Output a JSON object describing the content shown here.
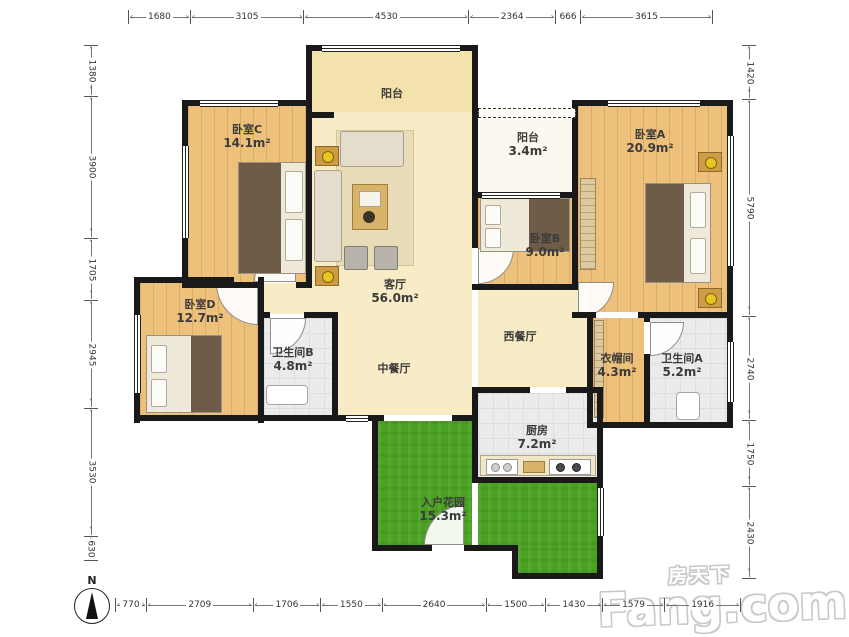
{
  "plan": {
    "rooms": [
      {
        "id": "bedroom-c",
        "name": "卧室C",
        "area": "14.1m²"
      },
      {
        "id": "balcony-top",
        "name": "阳台",
        "area": ""
      },
      {
        "id": "balcony-small",
        "name": "阳台",
        "area": "3.4m²"
      },
      {
        "id": "bedroom-a",
        "name": "卧室A",
        "area": "20.9m²"
      },
      {
        "id": "bedroom-b",
        "name": "卧室B",
        "area": "9.0m²"
      },
      {
        "id": "living-room",
        "name": "客厅",
        "area": "56.0m²"
      },
      {
        "id": "west-dining",
        "name": "西餐厅",
        "area": ""
      },
      {
        "id": "chinese-dining",
        "name": "中餐厅",
        "area": ""
      },
      {
        "id": "bedroom-d",
        "name": "卧室D",
        "area": "12.7m²"
      },
      {
        "id": "bathroom-b",
        "name": "卫生间B",
        "area": "4.8m²"
      },
      {
        "id": "cloakroom",
        "name": "衣帽间",
        "area": "4.3m²"
      },
      {
        "id": "bathroom-a",
        "name": "卫生间A",
        "area": "5.2m²"
      },
      {
        "id": "kitchen",
        "name": "厨房",
        "area": "7.2m²"
      },
      {
        "id": "entry-garden",
        "name": "入户花园",
        "area": "15.3m²"
      }
    ],
    "dimensions": {
      "top": [
        1680,
        3105,
        4530,
        2364,
        666,
        3615
      ],
      "left": [
        1380,
        3900,
        1705,
        2945,
        3530,
        630
      ],
      "right": [
        1420,
        5790,
        2740,
        1750,
        2430
      ],
      "bottom": [
        770,
        2709,
        1706,
        1550,
        2640,
        1500,
        1430,
        1579,
        1916
      ]
    },
    "compass_label": "N",
    "colors": {
      "wall": "#191919",
      "wood_floor": "#edc17c",
      "living_floor": "#f8ecc6",
      "balcony_floor": "#f4e2ad",
      "tile_floor": "#ebebe9",
      "grass": "#4aa122"
    }
  },
  "watermark": {
    "cn": "房天下",
    "en": "Fang.com"
  }
}
